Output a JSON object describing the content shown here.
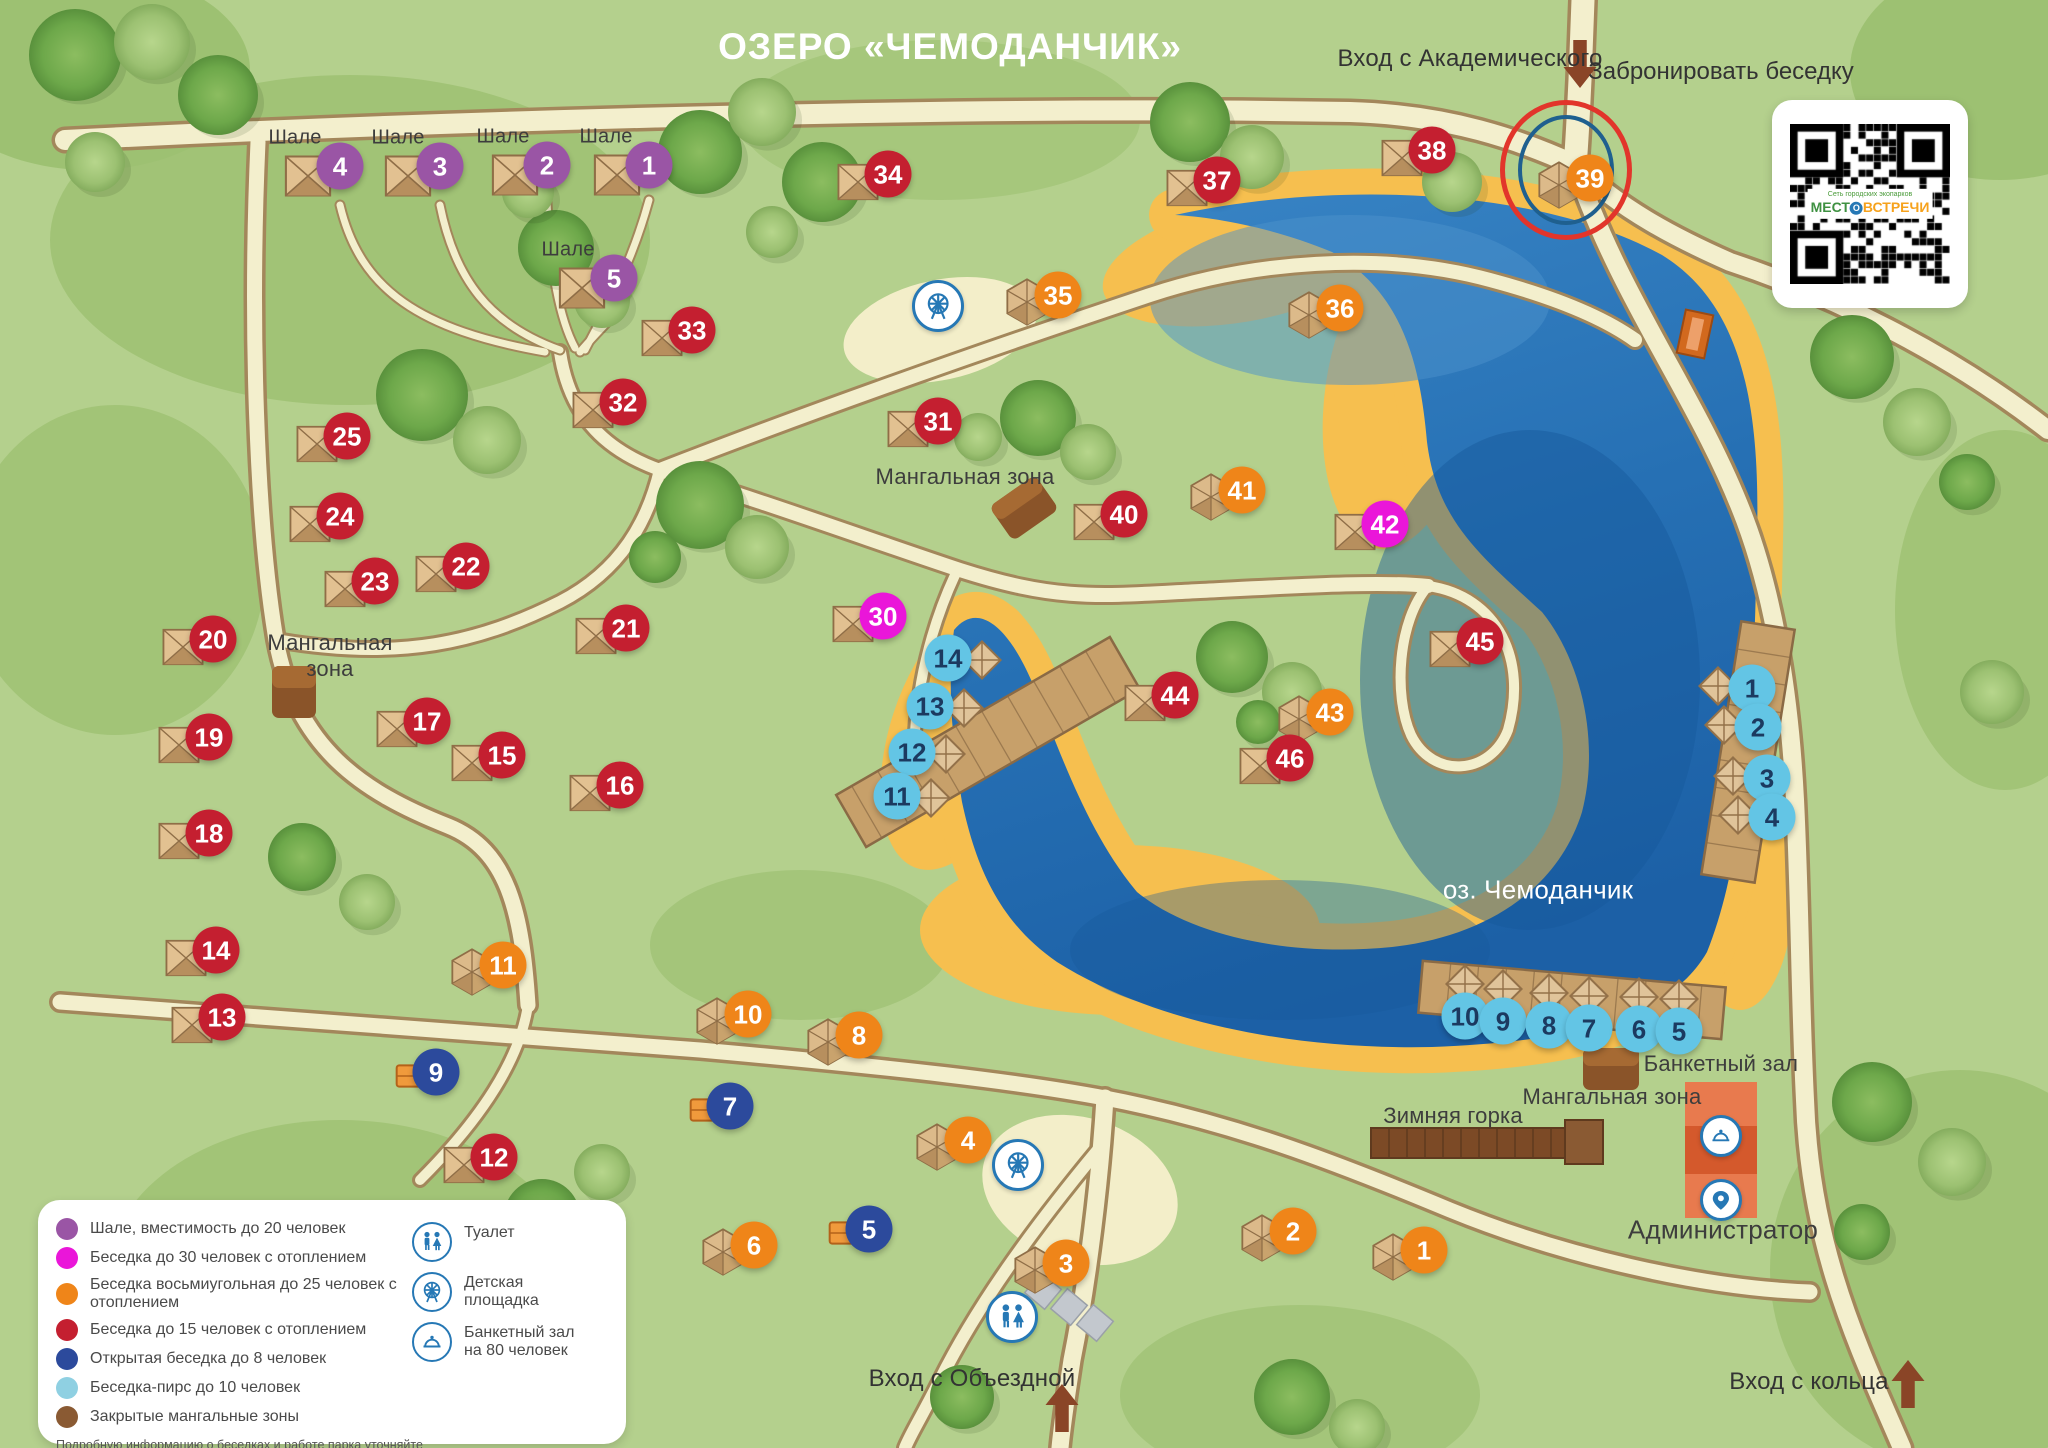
{
  "title": "ОЗЕРО «ЧЕМОДАНЧИК»",
  "booking": {
    "label": "Забронировать беседку",
    "qr_caption": "Сеть городских экопарков",
    "brand_part1": "МЕСТ",
    "brand_part2": "О",
    "brand_part3": "ВСТРЕЧИ"
  },
  "entrances": [
    {
      "label": "Вход с Академического",
      "x": 1470,
      "y": 59,
      "arrow": {
        "x": 1580,
        "y": 64,
        "dir": "down"
      }
    },
    {
      "label": "Вход с Объездной",
      "x": 972,
      "y": 1379,
      "arrow": {
        "x": 1062,
        "y": 1408,
        "dir": "up"
      }
    },
    {
      "label": "Вход с кольца",
      "x": 1809,
      "y": 1382,
      "arrow": {
        "x": 1908,
        "y": 1384,
        "dir": "up"
      }
    }
  ],
  "marker_types": {
    "chalet": {
      "label": "Шале, вместимость до 20 человек",
      "color": "#9a55a5"
    },
    "heated30": {
      "label": "Беседка до 30 человек с отоплением",
      "color": "#ea16d9"
    },
    "octagon25": {
      "label": "Беседка восьмиугольная до 25 человек с отоплением",
      "color": "#ef8519"
    },
    "heated15": {
      "label": "Беседка до 15 человек с отоплением",
      "color": "#c41f30"
    },
    "open8": {
      "label": "Открытая беседка до 8 человек",
      "color": "#2c4a9c"
    },
    "pier10": {
      "label": "Беседка-пирс до 10 человек",
      "color": "#63c5e5",
      "text_color": "#1c3a60"
    },
    "mangal": {
      "label": "Закрытые мангальные зоны",
      "color": "#8a5a33"
    }
  },
  "map": {
    "lake_name": "оз. Чемоданчик",
    "markers": [
      {
        "type": "chalet",
        "n": "4",
        "x": 340,
        "y": 166
      },
      {
        "type": "chalet",
        "n": "3",
        "x": 440,
        "y": 166
      },
      {
        "type": "chalet",
        "n": "2",
        "x": 547,
        "y": 165
      },
      {
        "type": "chalet",
        "n": "1",
        "x": 649,
        "y": 165
      },
      {
        "type": "chalet",
        "n": "5",
        "x": 614,
        "y": 278
      },
      {
        "type": "heated15",
        "n": "34",
        "x": 888,
        "y": 174
      },
      {
        "type": "heated15",
        "n": "37",
        "x": 1217,
        "y": 180
      },
      {
        "type": "heated15",
        "n": "38",
        "x": 1432,
        "y": 150
      },
      {
        "type": "heated15",
        "n": "33",
        "x": 692,
        "y": 330
      },
      {
        "type": "heated15",
        "n": "32",
        "x": 623,
        "y": 402
      },
      {
        "type": "heated15",
        "n": "31",
        "x": 938,
        "y": 421
      },
      {
        "type": "heated15",
        "n": "25",
        "x": 347,
        "y": 436
      },
      {
        "type": "heated15",
        "n": "24",
        "x": 340,
        "y": 516
      },
      {
        "type": "heated15",
        "n": "23",
        "x": 375,
        "y": 581
      },
      {
        "type": "heated15",
        "n": "22",
        "x": 466,
        "y": 566
      },
      {
        "type": "heated15",
        "n": "21",
        "x": 626,
        "y": 628
      },
      {
        "type": "heated15",
        "n": "20",
        "x": 213,
        "y": 639
      },
      {
        "type": "heated15",
        "n": "19",
        "x": 209,
        "y": 737
      },
      {
        "type": "heated15",
        "n": "18",
        "x": 209,
        "y": 833
      },
      {
        "type": "heated15",
        "n": "17",
        "x": 427,
        "y": 721
      },
      {
        "type": "heated15",
        "n": "15",
        "x": 502,
        "y": 755
      },
      {
        "type": "heated15",
        "n": "16",
        "x": 620,
        "y": 785
      },
      {
        "type": "heated15",
        "n": "14",
        "x": 216,
        "y": 950
      },
      {
        "type": "heated15",
        "n": "13",
        "x": 222,
        "y": 1017
      },
      {
        "type": "heated15",
        "n": "12",
        "x": 494,
        "y": 1157
      },
      {
        "type": "heated15",
        "n": "40",
        "x": 1124,
        "y": 514
      },
      {
        "type": "heated15",
        "n": "44",
        "x": 1175,
        "y": 695
      },
      {
        "type": "heated15",
        "n": "46",
        "x": 1290,
        "y": 758
      },
      {
        "type": "heated15",
        "n": "45",
        "x": 1480,
        "y": 641
      },
      {
        "type": "octagon25",
        "n": "39",
        "x": 1590,
        "y": 178,
        "highlight": true
      },
      {
        "type": "octagon25",
        "n": "35",
        "x": 1058,
        "y": 295
      },
      {
        "type": "octagon25",
        "n": "36",
        "x": 1340,
        "y": 308
      },
      {
        "type": "octagon25",
        "n": "41",
        "x": 1242,
        "y": 490
      },
      {
        "type": "octagon25",
        "n": "43",
        "x": 1330,
        "y": 712
      },
      {
        "type": "octagon25",
        "n": "11",
        "x": 503,
        "y": 965
      },
      {
        "type": "octagon25",
        "n": "10",
        "x": 748,
        "y": 1014
      },
      {
        "type": "octagon25",
        "n": "8",
        "x": 859,
        "y": 1035
      },
      {
        "type": "octagon25",
        "n": "4",
        "x": 968,
        "y": 1140
      },
      {
        "type": "octagon25",
        "n": "6",
        "x": 754,
        "y": 1245
      },
      {
        "type": "octagon25",
        "n": "3",
        "x": 1066,
        "y": 1263
      },
      {
        "type": "octagon25",
        "n": "2",
        "x": 1293,
        "y": 1231
      },
      {
        "type": "octagon25",
        "n": "1",
        "x": 1424,
        "y": 1250
      },
      {
        "type": "heated30",
        "n": "42",
        "x": 1385,
        "y": 524
      },
      {
        "type": "heated30",
        "n": "30",
        "x": 883,
        "y": 616
      },
      {
        "type": "open8",
        "n": "9",
        "x": 436,
        "y": 1072
      },
      {
        "type": "open8",
        "n": "7",
        "x": 730,
        "y": 1106
      },
      {
        "type": "open8",
        "n": "5",
        "x": 869,
        "y": 1229
      },
      {
        "type": "pier10",
        "n": "14",
        "x": 948,
        "y": 658,
        "pier": "left"
      },
      {
        "type": "pier10",
        "n": "13",
        "x": 930,
        "y": 706,
        "pier": "left"
      },
      {
        "type": "pier10",
        "n": "12",
        "x": 912,
        "y": 752,
        "pier": "left"
      },
      {
        "type": "pier10",
        "n": "11",
        "x": 897,
        "y": 796,
        "pier": "left"
      },
      {
        "type": "pier10",
        "n": "1",
        "x": 1752,
        "y": 688,
        "pier": "right"
      },
      {
        "type": "pier10",
        "n": "2",
        "x": 1758,
        "y": 727,
        "pier": "right"
      },
      {
        "type": "pier10",
        "n": "3",
        "x": 1767,
        "y": 778,
        "pier": "right"
      },
      {
        "type": "pier10",
        "n": "4",
        "x": 1772,
        "y": 817,
        "pier": "right"
      },
      {
        "type": "pier10",
        "n": "10",
        "x": 1465,
        "y": 1016,
        "pier": "bottom"
      },
      {
        "type": "pier10",
        "n": "9",
        "x": 1503,
        "y": 1021,
        "pier": "bottom"
      },
      {
        "type": "pier10",
        "n": "8",
        "x": 1549,
        "y": 1025,
        "pier": "bottom"
      },
      {
        "type": "pier10",
        "n": "7",
        "x": 1589,
        "y": 1028,
        "pier": "bottom"
      },
      {
        "type": "pier10",
        "n": "6",
        "x": 1639,
        "y": 1029,
        "pier": "bottom"
      },
      {
        "type": "pier10",
        "n": "5",
        "x": 1679,
        "y": 1031,
        "pier": "bottom"
      }
    ],
    "labels": [
      {
        "text": "Шале",
        "x": 295,
        "y": 138,
        "variant": "sm"
      },
      {
        "text": "Шале",
        "x": 398,
        "y": 138,
        "variant": "sm"
      },
      {
        "text": "Шале",
        "x": 503,
        "y": 137,
        "variant": "sm"
      },
      {
        "text": "Шале",
        "x": 606,
        "y": 137,
        "variant": "sm"
      },
      {
        "text": "Шале",
        "x": 568,
        "y": 250,
        "variant": "sm"
      },
      {
        "text": "Мангальная зона",
        "x": 965,
        "y": 477,
        "variant": "dark"
      },
      {
        "text": "Мангальная\nзона",
        "x": 330,
        "y": 656,
        "variant": "dark"
      },
      {
        "text": "Мангальная зона",
        "x": 1612,
        "y": 1097,
        "variant": "dark"
      },
      {
        "text": "Зимняя горка",
        "x": 1453,
        "y": 1116,
        "variant": "dark"
      },
      {
        "text": "Банкетный зал",
        "x": 1721,
        "y": 1064,
        "variant": "dark"
      },
      {
        "text": "Администратор",
        "x": 1723,
        "y": 1230,
        "variant": "lg"
      },
      {
        "text": "оз. Чемоданчик",
        "x": 1538,
        "y": 890,
        "variant": "white"
      }
    ],
    "icons": [
      {
        "icon": "playground-icon",
        "x": 938,
        "y": 306,
        "size": 46
      },
      {
        "icon": "playground-icon",
        "x": 1018,
        "y": 1165,
        "size": 46
      },
      {
        "icon": "toilet-icon",
        "x": 1012,
        "y": 1317,
        "size": 46
      },
      {
        "icon": "banquet-icon",
        "x": 1721,
        "y": 1136,
        "size": 36
      },
      {
        "icon": "pin-icon",
        "x": 1721,
        "y": 1200,
        "size": 36
      }
    ]
  },
  "legend": {
    "items": [
      {
        "color": "#9a55a5",
        "label": "Шале, вместимость до 20 человек"
      },
      {
        "color": "#ea16d9",
        "label": "Беседка до 30 человек с отоплением"
      },
      {
        "color": "#ef8519",
        "label": "Беседка восьмиугольная до 25 человек с отоплением"
      },
      {
        "color": "#c41f30",
        "label": "Беседка до 15 человек с отоплением"
      },
      {
        "color": "#2c4a9c",
        "label": "Открытая беседка до 8 человек"
      },
      {
        "color": "#8fd0e2",
        "label": "Беседка-пирс до 10 человек"
      },
      {
        "color": "#8a5a33",
        "label": "Закрытые мангальные зоны"
      }
    ],
    "services": [
      {
        "icon": "toilet-icon",
        "label": "Туалет"
      },
      {
        "icon": "playground-icon",
        "label": "Детская\nплощадка"
      },
      {
        "icon": "banquet-icon",
        "label": "Банкетный зал\nна 80 человек"
      }
    ],
    "footnote_line1": "Подробную информацию о беседках и работе парка уточняйте",
    "footnote_line2": "по телефону 301-55-05, на сайте park66.ru или в офисе продаж «Место встречи»."
  }
}
